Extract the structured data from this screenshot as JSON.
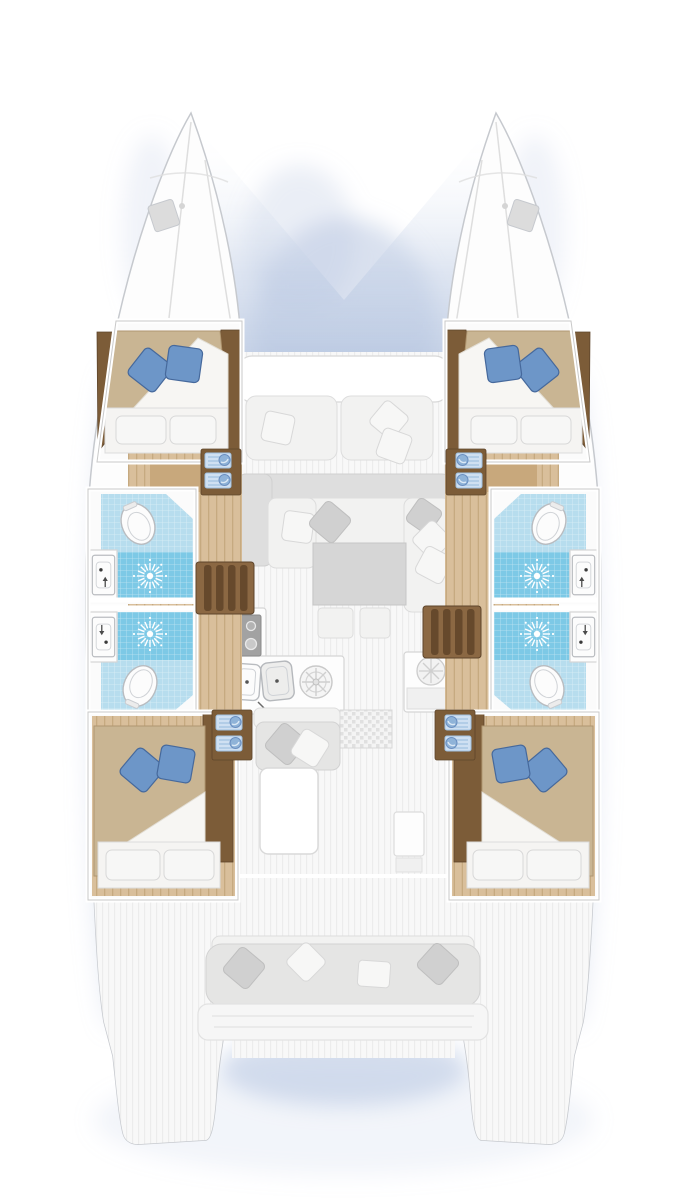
{
  "title": "Catamaran interior layout plan, top-down view, bow up",
  "vessel": {
    "type": "sailing catamaran floor plan",
    "view": "overhead deck and accommodation plan",
    "orientation": {
      "bow": "up",
      "stern": "down"
    }
  },
  "accommodation": {
    "cabins": [
      {
        "id": "forward-port-cabin",
        "bed": "double berth",
        "white_pillows": 2,
        "blue_pillows": 2
      },
      {
        "id": "forward-starboard-cabin",
        "bed": "double berth",
        "white_pillows": 2,
        "blue_pillows": 2
      },
      {
        "id": "aft-port-cabin",
        "bed": "double berth",
        "white_pillows": 2,
        "blue_pillows": 2
      },
      {
        "id": "aft-starboard-cabin",
        "bed": "double berth",
        "white_pillows": 2,
        "blue_pillows": 2
      }
    ],
    "heads": [
      {
        "id": "forward-port-head",
        "fixtures": [
          "toilet",
          "sink",
          "shower"
        ]
      },
      {
        "id": "aft-port-head",
        "fixtures": [
          "toilet",
          "sink",
          "shower"
        ]
      },
      {
        "id": "forward-starboard-head",
        "fixtures": [
          "toilet",
          "sink",
          "shower"
        ]
      },
      {
        "id": "aft-starboard-head",
        "fixtures": [
          "toilet",
          "sink",
          "shower"
        ]
      }
    ],
    "salon": {
      "sofa": "L-shaped settee with throw pillows",
      "table": "square saloon table",
      "ottomans": 2
    },
    "galley": {
      "stove_burners": 4,
      "sinks": 2,
      "round_hob": 1,
      "fridge_cabinet": 1
    },
    "stairs": [
      "port companionway steps",
      "starboard companionway steps"
    ],
    "foredeck": {
      "bench_cushions": 2,
      "pillows": 3,
      "trampoline": "netting area between bows"
    },
    "cockpit": {
      "side_bench": 1,
      "aft_bench_pillows": 4,
      "table": 1,
      "grating": 1
    },
    "swim_platforms": 2
  },
  "colors": {
    "shadow": "#b9c8e2",
    "hull_fill": "#fdfdfd",
    "hull_stroke": "#c6c9ce",
    "wall_edge": "#c9c9c9",
    "bow_line": "#dedede",
    "bow_hatch": "#dcdcdc",
    "deck_fill": "#f8f8f8",
    "deck_stripe": "#ececec",
    "wood_floor": "#d9bf9b",
    "wood_floor_stripe": "#c6aa80",
    "wood_mid": "#c8a87c",
    "wood_dark": "#7c5c38",
    "wood_dark_edge": "#5e452b",
    "stairs_wood": "#8b6843",
    "stairs_shadow": "#66492c",
    "bed_blanket": "#c9b593",
    "bed_blanket_dark": "#b09670",
    "mattress": "#f5f4f2",
    "pillow_white": "#f7f7f6",
    "pillow_gray": "#d0d0d0",
    "pillow_blue": "#6d96c8",
    "pillow_blue_dark": "#46699c",
    "tile_light": "#b7ddee",
    "tile_deep": "#7dc9e6",
    "fixture_white": "#fcfcfc",
    "fixture_stroke": "#b9bcc0",
    "cushion_gray": "#e5e5e4",
    "table_gray": "#d6d6d6",
    "stove": "#a2a2a2"
  }
}
